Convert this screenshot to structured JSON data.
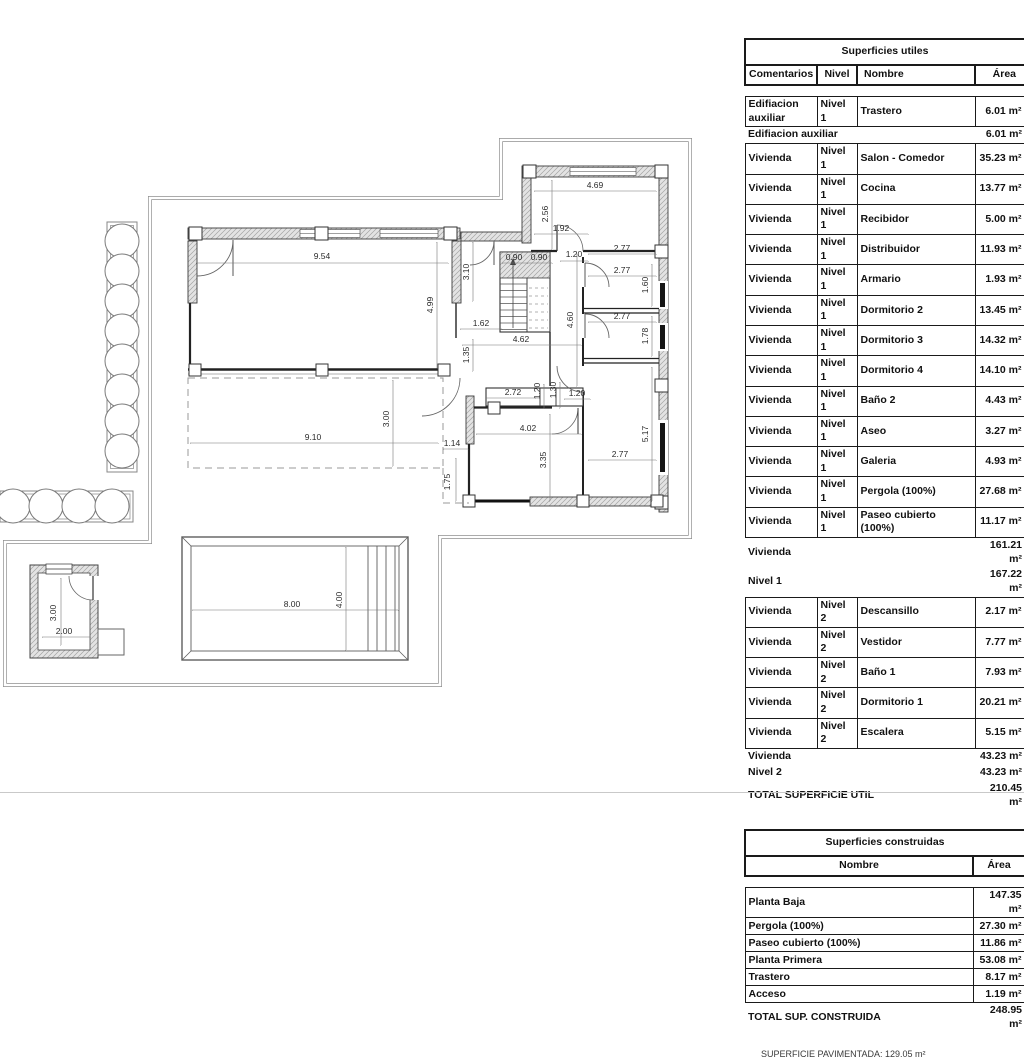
{
  "plan": {
    "dimensions": [
      {
        "t": "9.54",
        "x": 322,
        "y": 259
      },
      {
        "t": "4.99",
        "x": 433,
        "y": 305,
        "v": true
      },
      {
        "t": "3.10",
        "x": 469,
        "y": 272,
        "v": true
      },
      {
        "t": "1.62",
        "x": 481,
        "y": 326
      },
      {
        "t": "1.35",
        "x": 469,
        "y": 355,
        "v": true
      },
      {
        "t": "4.62",
        "x": 521,
        "y": 342
      },
      {
        "t": "4.60",
        "x": 573,
        "y": 320,
        "v": true
      },
      {
        "t": "0.90",
        "x": 514,
        "y": 260
      },
      {
        "t": "0.90",
        "x": 539,
        "y": 260
      },
      {
        "t": "1.20",
        "x": 574,
        "y": 257
      },
      {
        "t": "4.69",
        "x": 595,
        "y": 188
      },
      {
        "t": "2.56",
        "x": 548,
        "y": 214,
        "v": true
      },
      {
        "t": "1.92",
        "x": 561,
        "y": 231
      },
      {
        "t": "2.77",
        "x": 622,
        "y": 251
      },
      {
        "t": "2.77",
        "x": 622,
        "y": 273
      },
      {
        "t": "1.60",
        "x": 648,
        "y": 285,
        "v": true
      },
      {
        "t": "2.77",
        "x": 622,
        "y": 319
      },
      {
        "t": "1.78",
        "x": 648,
        "y": 336,
        "v": true
      },
      {
        "t": "2.72",
        "x": 513,
        "y": 395
      },
      {
        "t": "1.20",
        "x": 540,
        "y": 391,
        "v": true
      },
      {
        "t": "1.30",
        "x": 556,
        "y": 390,
        "v": true
      },
      {
        "t": "1.20",
        "x": 577,
        "y": 396
      },
      {
        "t": "4.02",
        "x": 528,
        "y": 431
      },
      {
        "t": "3.35",
        "x": 546,
        "y": 460,
        "v": true
      },
      {
        "t": "2.77",
        "x": 620,
        "y": 457
      },
      {
        "t": "5.17",
        "x": 648,
        "y": 434,
        "v": true
      },
      {
        "t": "9.10",
        "x": 313,
        "y": 440
      },
      {
        "t": "3.00",
        "x": 389,
        "y": 419,
        "v": true
      },
      {
        "t": "1.14",
        "x": 452,
        "y": 446
      },
      {
        "t": "1.75",
        "x": 450,
        "y": 482,
        "v": true
      },
      {
        "t": "8.00",
        "x": 292,
        "y": 607
      },
      {
        "t": "4.00",
        "x": 342,
        "y": 600,
        "v": true
      },
      {
        "t": "3.00",
        "x": 56,
        "y": 613,
        "v": true
      },
      {
        "t": "2.00",
        "x": 64,
        "y": 634
      }
    ]
  },
  "tables": [
    {
      "title": "Superficies utiles",
      "columns": [
        "Comentarios",
        "Nivel",
        "Nombre",
        "Área"
      ],
      "col_widths": [
        72,
        40,
        118,
        50
      ],
      "header_align": [
        "c",
        "c",
        "l",
        "r"
      ],
      "rows": [
        {
          "type": "data",
          "cells": [
            "Edifiacion auxiliar",
            "Nivel 1",
            "Trastero"
          ],
          "area": "6.01 m²"
        },
        {
          "type": "sub",
          "label": "Edifiacion auxiliar",
          "area": "6.01 m²"
        },
        {
          "type": "data",
          "cells": [
            "Vivienda",
            "Nivel 1",
            "Salon - Comedor"
          ],
          "area": "35.23 m²"
        },
        {
          "type": "data",
          "cells": [
            "Vivienda",
            "Nivel 1",
            "Cocina"
          ],
          "area": "13.77 m²"
        },
        {
          "type": "data",
          "cells": [
            "Vivienda",
            "Nivel 1",
            "Recibidor"
          ],
          "area": "5.00 m²"
        },
        {
          "type": "data",
          "cells": [
            "Vivienda",
            "Nivel 1",
            "Distribuidor"
          ],
          "area": "11.93 m²"
        },
        {
          "type": "data",
          "cells": [
            "Vivienda",
            "Nivel 1",
            "Armario"
          ],
          "area": "1.93 m²"
        },
        {
          "type": "data",
          "cells": [
            "Vivienda",
            "Nivel 1",
            "Dormitorio 2"
          ],
          "area": "13.45 m²"
        },
        {
          "type": "data",
          "cells": [
            "Vivienda",
            "Nivel 1",
            "Dormitorio 3"
          ],
          "area": "14.32 m²"
        },
        {
          "type": "data",
          "cells": [
            "Vivienda",
            "Nivel 1",
            "Dormitorio 4"
          ],
          "area": "14.10 m²"
        },
        {
          "type": "data",
          "cells": [
            "Vivienda",
            "Nivel 1",
            "Baño 2"
          ],
          "area": "4.43 m²"
        },
        {
          "type": "data",
          "cells": [
            "Vivienda",
            "Nivel 1",
            "Aseo"
          ],
          "area": "3.27 m²"
        },
        {
          "type": "data",
          "cells": [
            "Vivienda",
            "Nivel 1",
            "Galeria"
          ],
          "area": "4.93 m²"
        },
        {
          "type": "data",
          "cells": [
            "Vivienda",
            "Nivel 1",
            "Pergola (100%)"
          ],
          "area": "27.68 m²"
        },
        {
          "type": "data",
          "cells": [
            "Vivienda",
            "Nivel 1",
            "Paseo cubierto (100%)"
          ],
          "area": "11.17 m²"
        },
        {
          "type": "sub",
          "label": "Vivienda",
          "area": "161.21 m²"
        },
        {
          "type": "sub",
          "label": "Nivel 1",
          "area": "167.22 m²"
        },
        {
          "type": "data",
          "cells": [
            "Vivienda",
            "Nivel 2",
            "Descansillo"
          ],
          "area": "2.17 m²"
        },
        {
          "type": "data",
          "cells": [
            "Vivienda",
            "Nivel 2",
            "Vestidor"
          ],
          "area": "7.77 m²"
        },
        {
          "type": "data",
          "cells": [
            "Vivienda",
            "Nivel 2",
            "Baño 1"
          ],
          "area": "7.93 m²"
        },
        {
          "type": "data",
          "cells": [
            "Vivienda",
            "Nivel 2",
            "Dormitorio 1"
          ],
          "area": "20.21 m²"
        },
        {
          "type": "data",
          "cells": [
            "Vivienda",
            "Nivel 2",
            "Escalera"
          ],
          "area": "5.15 m²"
        },
        {
          "type": "sub",
          "label": "Vivienda",
          "area": "43.23 m²"
        },
        {
          "type": "sub",
          "label": "Nivel 2",
          "area": "43.23 m²"
        },
        {
          "type": "total",
          "label": "TOTAL SUPERFICIE UTIL",
          "area": "210.45 m²"
        }
      ]
    },
    {
      "title": "Superficies construidas",
      "columns": [
        "Nombre",
        "Área"
      ],
      "col_widths": [
        228,
        52
      ],
      "header_align": [
        "c",
        "c"
      ],
      "rows": [
        {
          "type": "data",
          "cells": [
            "Planta Baja"
          ],
          "area": "147.35 m²"
        },
        {
          "type": "data",
          "cells": [
            "Pergola (100%)"
          ],
          "area": "27.30 m²"
        },
        {
          "type": "data",
          "cells": [
            "Paseo cubierto (100%)"
          ],
          "area": "11.86 m²"
        },
        {
          "type": "data",
          "cells": [
            "Planta Primera"
          ],
          "area": "53.08 m²"
        },
        {
          "type": "data",
          "cells": [
            "Trastero"
          ],
          "area": "8.17 m²"
        },
        {
          "type": "data",
          "cells": [
            "Acceso"
          ],
          "area": "1.19 m²"
        },
        {
          "type": "total",
          "label": "TOTAL SUP. CONSTRUIDA",
          "area": "248.95 m²"
        }
      ]
    }
  ],
  "footer": {
    "note": "SUPERFICIE PAVIMENTADA: 129.05 m²"
  }
}
